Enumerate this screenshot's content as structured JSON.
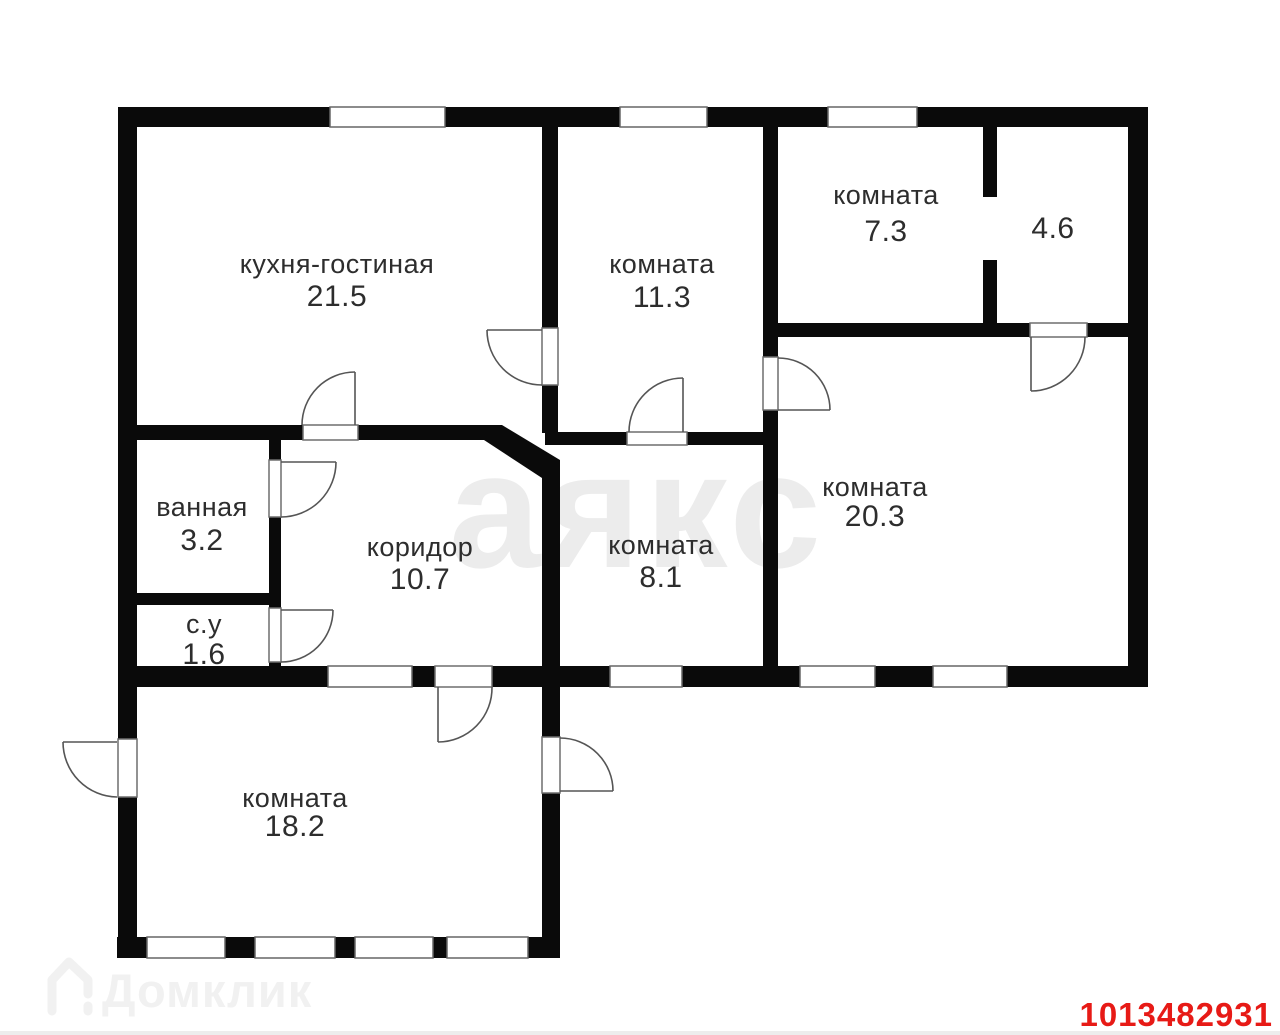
{
  "watermark": {
    "text": "аякс",
    "color": "#ececec"
  },
  "rooms": [
    {
      "name": "кухня-гостиная",
      "area": "21.5"
    },
    {
      "name": "комната",
      "area": "11.3"
    },
    {
      "name": "комната",
      "area": "7.3"
    },
    {
      "name": "",
      "area": "4.6"
    },
    {
      "name": "ванная",
      "area": "3.2"
    },
    {
      "name": "с.у",
      "area": "1.6"
    },
    {
      "name": "коридор",
      "area": "10.7"
    },
    {
      "name": "комната",
      "area": "8.1"
    },
    {
      "name": "комната",
      "area": "20.3"
    },
    {
      "name": "комната",
      "area": "18.2"
    }
  ],
  "footer": {
    "brand": "Домклик",
    "brand_color": "#f1f1f1",
    "listing_id": "1013482931",
    "listing_id_color": "#e71a16"
  },
  "colors": {
    "wall": "#0a0a0a",
    "background": "#ffffff"
  }
}
